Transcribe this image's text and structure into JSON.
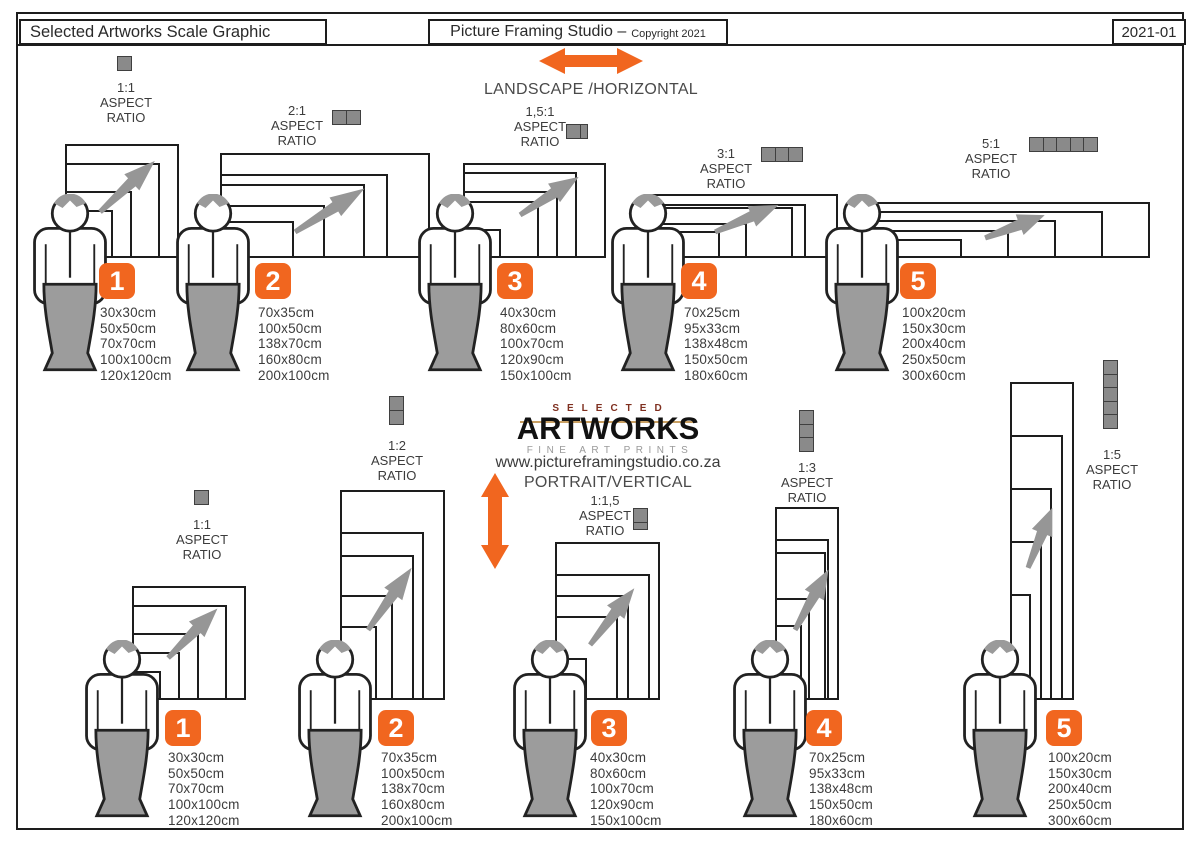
{
  "header": {
    "left_title": "Selected Artworks Scale Graphic",
    "studio_title": "Picture Framing Studio –",
    "copyright_note": "Copyright 2021",
    "doc_ref": "2021-01"
  },
  "logo": {
    "brand_top": "SELECTED",
    "brand_main": "ARTWORKS",
    "brand_sub": "FINE ART PRINTS",
    "website": "www.pictureframingstudio.co.za"
  },
  "aspect_words": [
    "ASPECT",
    "RATIO"
  ],
  "sections": {
    "landscape": {
      "label": "LANDSCAPE /HORIZONTAL",
      "groups": [
        {
          "number": "1",
          "ratio": "1:1",
          "sizes": [
            "30x30cm",
            "50x50cm",
            "70x70cm",
            "100x100cm",
            "120x120cm"
          ]
        },
        {
          "number": "2",
          "ratio": "2:1",
          "sizes": [
            "70x35cm",
            "100x50cm",
            "138x70cm",
            "160x80cm",
            "200x100cm"
          ]
        },
        {
          "number": "3",
          "ratio": "1,5:1",
          "sizes": [
            "40x30cm",
            "80x60cm",
            "100x70cm",
            "120x90cm",
            "150x100cm"
          ]
        },
        {
          "number": "4",
          "ratio": "3:1",
          "sizes": [
            "70x25cm",
            "95x33cm",
            "138x48cm",
            "150x50cm",
            "180x60cm"
          ]
        },
        {
          "number": "5",
          "ratio": "5:1",
          "sizes": [
            "100x20cm",
            "150x30cm",
            "200x40cm",
            "250x50cm",
            "300x60cm"
          ]
        }
      ]
    },
    "portrait": {
      "label": "PORTRAIT/VERTICAL",
      "groups": [
        {
          "number": "1",
          "ratio": "1:1",
          "sizes": [
            "30x30cm",
            "50x50cm",
            "70x70cm",
            "100x100cm",
            "120x120cm"
          ]
        },
        {
          "number": "2",
          "ratio": "1:2",
          "sizes": [
            "70x35cm",
            "100x50cm",
            "138x70cm",
            "160x80cm",
            "200x100cm"
          ]
        },
        {
          "number": "3",
          "ratio": "1:1,5",
          "sizes": [
            "40x30cm",
            "80x60cm",
            "100x70cm",
            "120x90cm",
            "150x100cm"
          ]
        },
        {
          "number": "4",
          "ratio": "1:3",
          "sizes": [
            "70x25cm",
            "95x33cm",
            "138x48cm",
            "150x50cm",
            "180x60cm"
          ]
        },
        {
          "number": "5",
          "ratio": "1:5",
          "sizes": [
            "100x20cm",
            "150x30cm",
            "200x40cm",
            "250x50cm",
            "300x60cm"
          ]
        }
      ]
    }
  },
  "colors": {
    "accent_orange": "#F1661F",
    "unit_gray": "#8A8A8A",
    "figure_gray": "#9C9C9C",
    "arrow_gray": "#969696"
  }
}
